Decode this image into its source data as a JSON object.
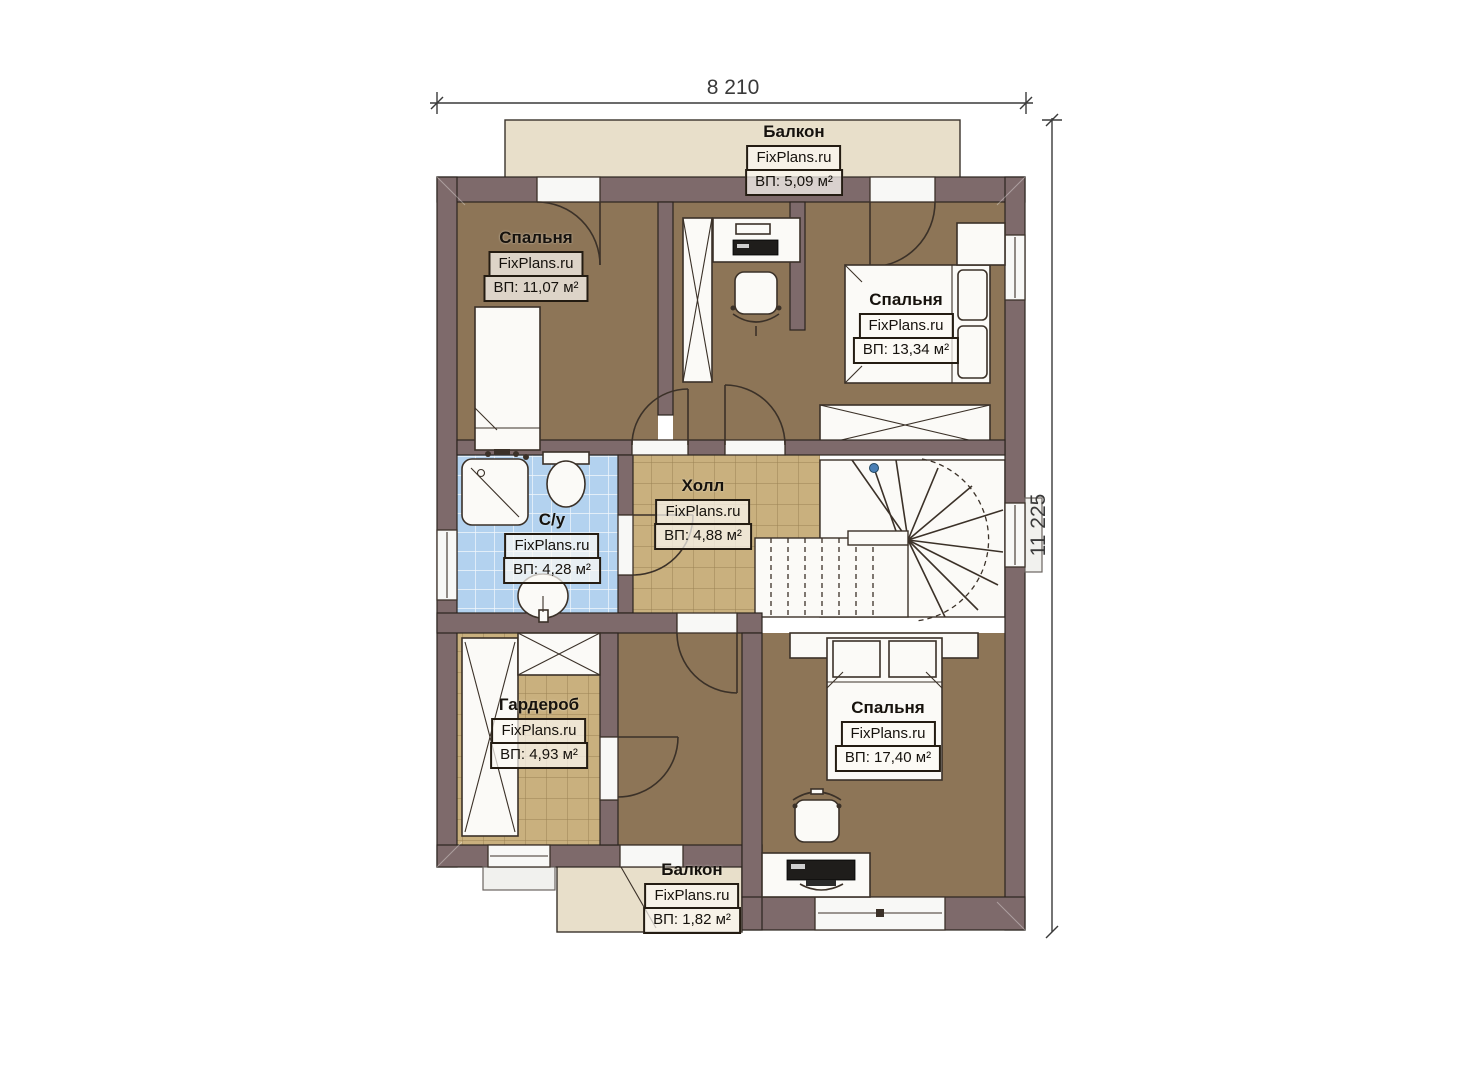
{
  "title": "Floor plan — second level",
  "dimensions": {
    "width_label": "8 210",
    "height_label": "11 225"
  },
  "rooms": {
    "balcony_top": {
      "name": "Балкон",
      "brand": "FixPlans.ru",
      "area": "ВП: 5,09 м²"
    },
    "bedroom_tl": {
      "name": "Спальня",
      "brand": "FixPlans.ru",
      "area": "ВП: 11,07 м²"
    },
    "bedroom_tr": {
      "name": "Спальня",
      "brand": "FixPlans.ru",
      "area": "ВП: 13,34 м²"
    },
    "bathroom": {
      "name": "С/у",
      "brand": "FixPlans.ru",
      "area": "ВП: 4,28 м²"
    },
    "hall": {
      "name": "Холл",
      "brand": "FixPlans.ru",
      "area": "ВП: 4,88 м²"
    },
    "wardrobe": {
      "name": "Гардероб",
      "brand": "FixPlans.ru",
      "area": "ВП: 4,93 м²"
    },
    "bedroom_bottom": {
      "name": "Спальня",
      "brand": "FixPlans.ru",
      "area": "ВП: 17,40 м²"
    },
    "balcony_bottom": {
      "name": "Балкон",
      "brand": "FixPlans.ru",
      "area": "ВП: 1,82 м²"
    }
  },
  "palette": {
    "wall": "#7e6a6b",
    "floor_wood": "#8d7557",
    "tile_tan": "#c9b07e",
    "tile_tan_line": "#9a8254",
    "tile_blue": "#b3d2ef",
    "balcony": "#e8dfca",
    "fixture_white": "#fbfaf7",
    "stair_dot_blue": "#4a7fb5"
  }
}
